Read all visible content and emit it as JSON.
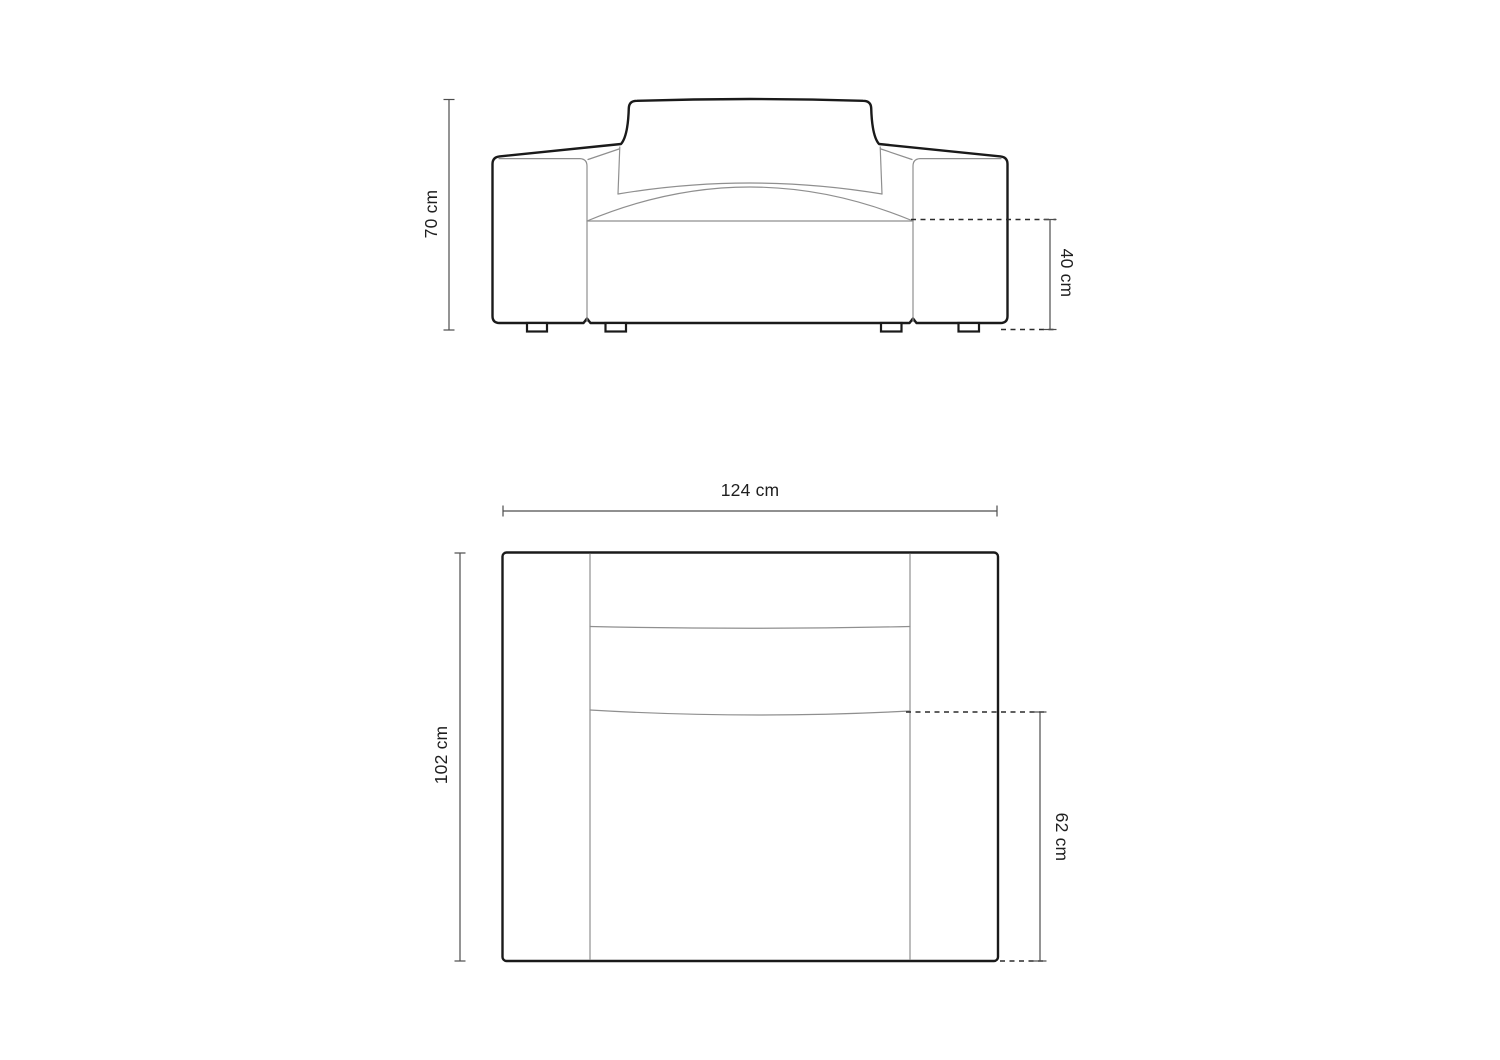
{
  "diagram": {
    "subject_label": "armchair dimension drawing",
    "unit": "cm",
    "dimensions": {
      "height": {
        "label": "70 cm",
        "value": 70
      },
      "seat_height": {
        "label": "40 cm",
        "value": 40
      },
      "width": {
        "label": "124 cm",
        "value": 124
      },
      "depth": {
        "label": "102 cm",
        "value": 102
      },
      "seat_depth": {
        "label": "62 cm",
        "value": 62
      }
    },
    "colors": {
      "background": "#ffffff",
      "outline": "#1a1a1a",
      "seam_line": "#8f8f8f",
      "dimension_line": "#4d4d4d",
      "dashed_line": "#2b2b2b",
      "text": "#1f1f1f"
    }
  }
}
